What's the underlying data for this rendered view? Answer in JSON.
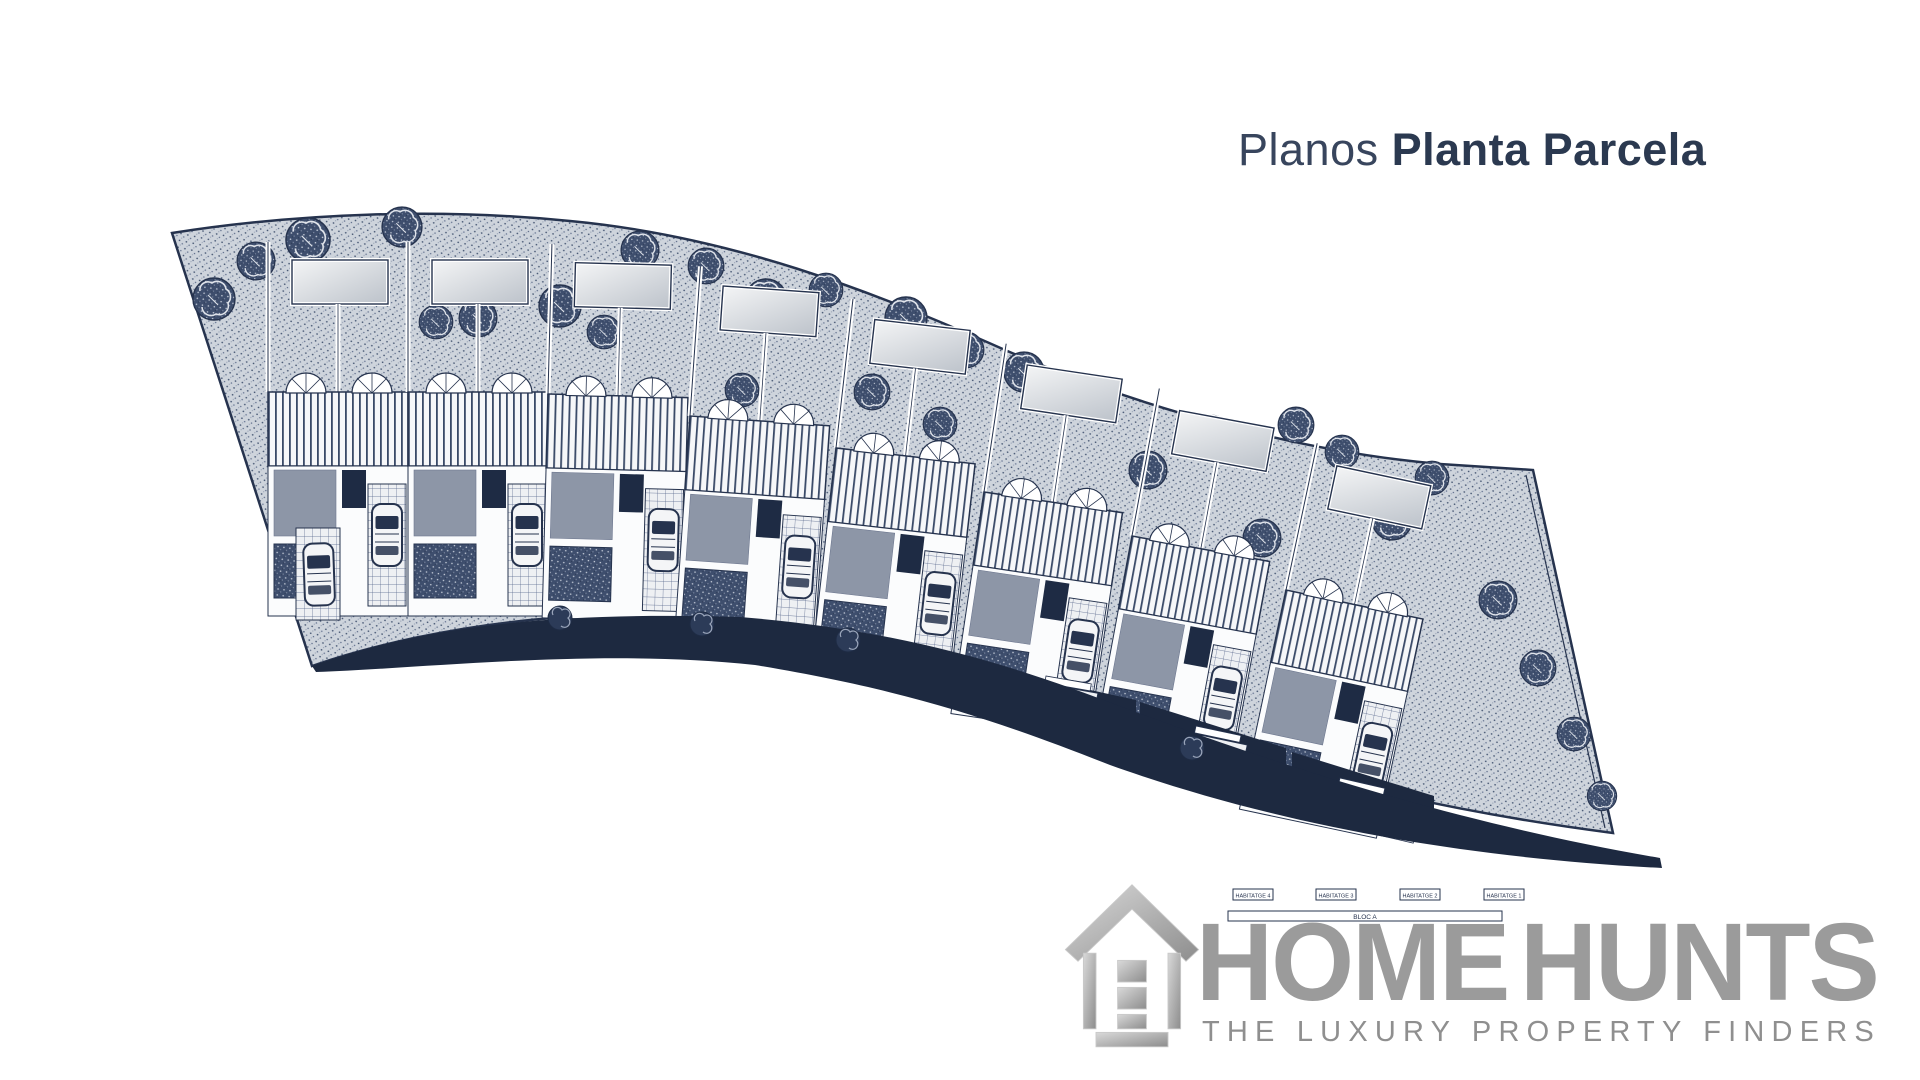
{
  "header": {
    "title_regular": "Planos",
    "title_bold": "Planta Parcela"
  },
  "plan": {
    "kind": "architectural-site-plan",
    "legend": {
      "units": [
        "HABITATGE 4",
        "HABITATGE 3",
        "HABITATGE 2",
        "HABITATGE 1"
      ],
      "block": "BLOC A"
    },
    "colors": {
      "navy_line": "#26334e",
      "road": "#1d2940",
      "ground_stipple": "#ced4dc",
      "dark_stipple": "#3e4e6d",
      "terrace_gray": "#8d96a7",
      "roof_light": "#f4f5f6"
    }
  },
  "logo": {
    "brand_first": "HOME",
    "brand_second": "HUNTS",
    "tagline": "THE LUXURY PROPERTY FINDERS",
    "gray": "#9b9b9b"
  }
}
